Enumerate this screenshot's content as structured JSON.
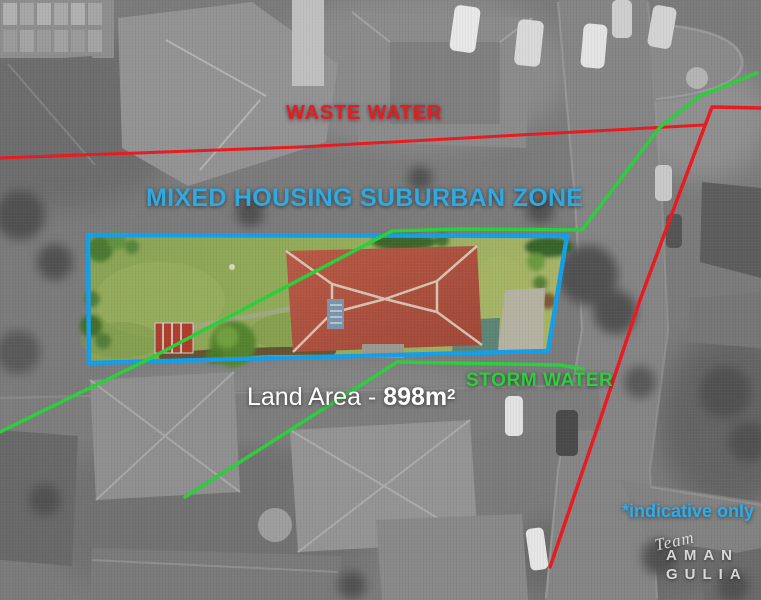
{
  "colors": {
    "red": "#e81b21",
    "green": "#2ccf3c",
    "zone_blue": "#2fa9e1",
    "boundary_blue": "#149fe8",
    "cyan": "#2badee",
    "white": "#ffffff"
  },
  "annotations": {
    "waste_water": "WASTE WATER",
    "zone": "MIXED HOUSING SUBURBAN ZONE",
    "storm_water": "STORM WATER",
    "land_area_prefix": "Land Area - ",
    "land_area_value": "898m",
    "land_area_sup": "2",
    "indicative": "*indicative only"
  },
  "watermark": {
    "script": "Team",
    "name_line1": "AMAN",
    "name_line2": "GULIA"
  }
}
